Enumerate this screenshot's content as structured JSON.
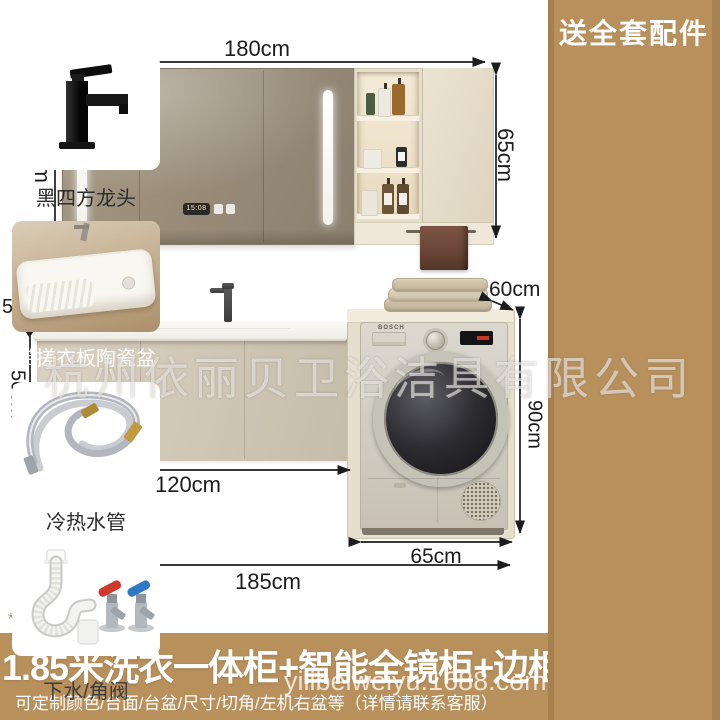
{
  "dimensions": {
    "mirror_width": "180cm",
    "mirror_height_left": "65cm",
    "mirror_height_right": "65cm",
    "counter_depth": "50cm",
    "vanity_height": "50cm",
    "washer_depth": "60cm",
    "washer_height": "90cm",
    "vanity_width": "120cm",
    "washer_width": "65cm",
    "total_width": "185cm"
  },
  "product": {
    "mirror_display_time": "15:08",
    "washer_brand": "BOSCH"
  },
  "sidebar": {
    "title": "送全套配件",
    "items": [
      {
        "label": "黑四方龙头"
      },
      {
        "label": "带搓衣板陶瓷盆"
      },
      {
        "label": "冷热水管"
      },
      {
        "label": "下水/角阀"
      }
    ]
  },
  "banner": {
    "title": "1.85米洗衣一体柜+智能全镜柜+边柜",
    "subtitle": "可定制颜色/台面/台盆/尺寸/切角/左机右盆等（详情请联系客服）"
  },
  "watermarks": {
    "company": "杭州依丽贝卫浴洁具有限公司",
    "site": "yilibeiweiyu.1688.com"
  },
  "note": "*图为左盆右机"
}
